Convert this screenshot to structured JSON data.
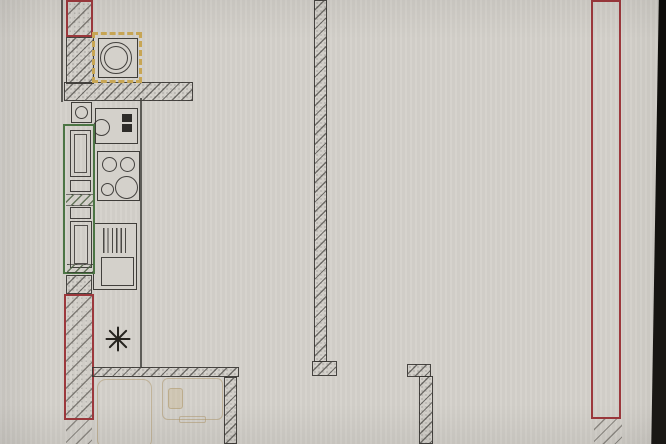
{
  "palette": {
    "paper": "#d4d1cb",
    "line": "#3c3b38",
    "red": "#9c383c",
    "green": "#4c7544",
    "yellow": "#c8a654",
    "pencil": "#b39a6e",
    "photo-edge": "#161412"
  },
  "plan": {
    "canvas": {
      "width": 666,
      "height": 444
    },
    "elements": [
      {
        "n": "wall-edge-line-top-left",
        "c": "ln",
        "x": 61,
        "y": 0,
        "w": 2,
        "h": 102
      },
      {
        "n": "wall-top-left-red",
        "c": "wall wall-red",
        "x": 66,
        "y": 0,
        "w": 27,
        "h": 37
      },
      {
        "n": "wall-left-upper",
        "c": "wall",
        "x": 66,
        "y": 37,
        "w": 28,
        "h": 47
      },
      {
        "n": "wall-top-horizontal",
        "c": "wall",
        "x": 64,
        "y": 82,
        "w": 129,
        "h": 19
      },
      {
        "n": "wall-left-mid",
        "c": "wall",
        "x": 66,
        "y": 275,
        "w": 26,
        "h": 19
      },
      {
        "n": "wall-left-red",
        "c": "wall wall-red",
        "x": 64,
        "y": 294,
        "w": 30,
        "h": 126
      },
      {
        "n": "wall-left-bottom",
        "c": "wall-sparse",
        "x": 66,
        "y": 420,
        "w": 26,
        "h": 24
      },
      {
        "n": "wall-bottom-horizontal",
        "c": "wall",
        "x": 92,
        "y": 367,
        "w": 147,
        "h": 10
      },
      {
        "n": "wall-inner-vertical-bottom",
        "c": "wall",
        "x": 224,
        "y": 377,
        "w": 13,
        "h": 67
      },
      {
        "n": "wall-middle-vertical",
        "c": "wall",
        "x": 314,
        "y": 0,
        "w": 13,
        "h": 362
      },
      {
        "n": "wall-middle-foot",
        "c": "wall",
        "x": 312,
        "y": 361,
        "w": 25,
        "h": 15
      },
      {
        "n": "wall-doorway-flange",
        "c": "wall",
        "x": 407,
        "y": 364,
        "w": 24,
        "h": 13
      },
      {
        "n": "wall-lower-right-vertical",
        "c": "wall",
        "x": 419,
        "y": 376,
        "w": 14,
        "h": 68
      },
      {
        "n": "wall-right-red",
        "c": "wall wall-red-alt",
        "x": 591,
        "y": 0,
        "w": 30,
        "h": 419
      },
      {
        "n": "wall-right-bottom",
        "c": "wall-sparse",
        "x": 594,
        "y": 419,
        "w": 28,
        "h": 25
      },
      {
        "n": "kitchen-zone-line",
        "c": "ln",
        "x": 140,
        "y": 98,
        "w": 2,
        "h": 269
      },
      {
        "n": "boiler-yellow-frame",
        "c": "yellow-sq",
        "x": 92,
        "y": 32,
        "w": 50,
        "h": 51
      },
      {
        "n": "boiler-box",
        "c": "box",
        "x": 98,
        "y": 38,
        "w": 40,
        "h": 40
      },
      {
        "n": "boiler-drum-outer",
        "c": "circ",
        "x": 100,
        "y": 42,
        "w": 32,
        "h": 32
      },
      {
        "n": "boiler-drum-inner",
        "c": "circ",
        "x": 104,
        "y": 46,
        "w": 24,
        "h": 24
      },
      {
        "n": "vent-box",
        "c": "box",
        "x": 71,
        "y": 102,
        "w": 21,
        "h": 21
      },
      {
        "n": "vent-circle",
        "c": "circ",
        "x": 75,
        "y": 106,
        "w": 13,
        "h": 13
      },
      {
        "n": "counter-sink",
        "c": "box",
        "x": 95,
        "y": 108,
        "w": 43,
        "h": 36
      },
      {
        "n": "sink-bowl",
        "c": "circ",
        "x": 93,
        "y": 119,
        "w": 17,
        "h": 17
      },
      {
        "n": "switch-block-1",
        "c": "fill-dark",
        "x": 122,
        "y": 114,
        "w": 10,
        "h": 8
      },
      {
        "n": "switch-block-2",
        "c": "fill-dark",
        "x": 122,
        "y": 124,
        "w": 10,
        "h": 8
      },
      {
        "n": "cooktop",
        "c": "box",
        "x": 97,
        "y": 151,
        "w": 43,
        "h": 50
      },
      {
        "n": "burner-top-left",
        "c": "circ",
        "x": 102,
        "y": 157,
        "w": 15,
        "h": 15
      },
      {
        "n": "burner-top-right",
        "c": "circ",
        "x": 120,
        "y": 157,
        "w": 15,
        "h": 15
      },
      {
        "n": "burner-bottom-left",
        "c": "circ",
        "x": 101,
        "y": 183,
        "w": 13,
        "h": 13
      },
      {
        "n": "burner-bottom-right",
        "c": "circ",
        "x": 115,
        "y": 176,
        "w": 23,
        "h": 23
      },
      {
        "n": "sink-unit",
        "c": "box",
        "x": 93,
        "y": 223,
        "w": 44,
        "h": 67
      },
      {
        "n": "drainboard-lines",
        "c": "drain",
        "x": 103,
        "y": 228,
        "w": 23,
        "h": 25
      },
      {
        "n": "sink-basin",
        "c": "box2",
        "x": 101,
        "y": 257,
        "w": 33,
        "h": 29
      },
      {
        "n": "tall-cabinet-frame",
        "c": "green-box",
        "x": 63,
        "y": 124,
        "w": 32,
        "h": 150
      },
      {
        "n": "cabinet-1",
        "c": "box2",
        "x": 70,
        "y": 130,
        "w": 21,
        "h": 47
      },
      {
        "n": "cabinet-1-inner",
        "c": "box3",
        "x": 74,
        "y": 134,
        "w": 13,
        "h": 39
      },
      {
        "n": "cabinet-2",
        "c": "box2",
        "x": 70,
        "y": 180,
        "w": 21,
        "h": 12
      },
      {
        "n": "cabinet-hatch-band",
        "c": "hatch-band",
        "x": 66,
        "y": 194,
        "w": 27,
        "h": 12
      },
      {
        "n": "cabinet-3",
        "c": "box2",
        "x": 70,
        "y": 207,
        "w": 21,
        "h": 12
      },
      {
        "n": "cabinet-4",
        "c": "box2",
        "x": 70,
        "y": 221,
        "w": 22,
        "h": 47
      },
      {
        "n": "cabinet-4-inner",
        "c": "box3",
        "x": 74,
        "y": 225,
        "w": 14,
        "h": 39
      },
      {
        "n": "cabinet-hatch-bottom",
        "c": "hatch-band",
        "x": 67,
        "y": 264,
        "w": 26,
        "h": 9
      },
      {
        "n": "pencil-bathtub",
        "c": "pencil",
        "x": 97,
        "y": 379,
        "w": 55,
        "h": 70,
        "r": 9
      },
      {
        "n": "pencil-fixture",
        "c": "pencil",
        "x": 162,
        "y": 378,
        "w": 61,
        "h": 42,
        "r": 6
      },
      {
        "n": "pencil-fixture-inner",
        "c": "pencil pencil-fill",
        "x": 168,
        "y": 388,
        "w": 15,
        "h": 21,
        "r": 3
      },
      {
        "n": "pencil-fixture-tab",
        "c": "pencil",
        "x": 179,
        "y": 416,
        "w": 27,
        "h": 7,
        "r": 2
      },
      {
        "n": "freezer-symbol",
        "c": "snowflake",
        "x": 105,
        "y": 326,
        "w": 25,
        "h": 25,
        "spokes": [
          0,
          45,
          90,
          135
        ]
      },
      {
        "n": "photo-edge-right",
        "c": "photo-edge",
        "x": 650,
        "y": 0,
        "w": 16,
        "h": 444
      },
      {
        "n": "photo-vignette",
        "c": "vignette",
        "x": 0,
        "y": 0,
        "w": 666,
        "h": 444
      }
    ]
  }
}
